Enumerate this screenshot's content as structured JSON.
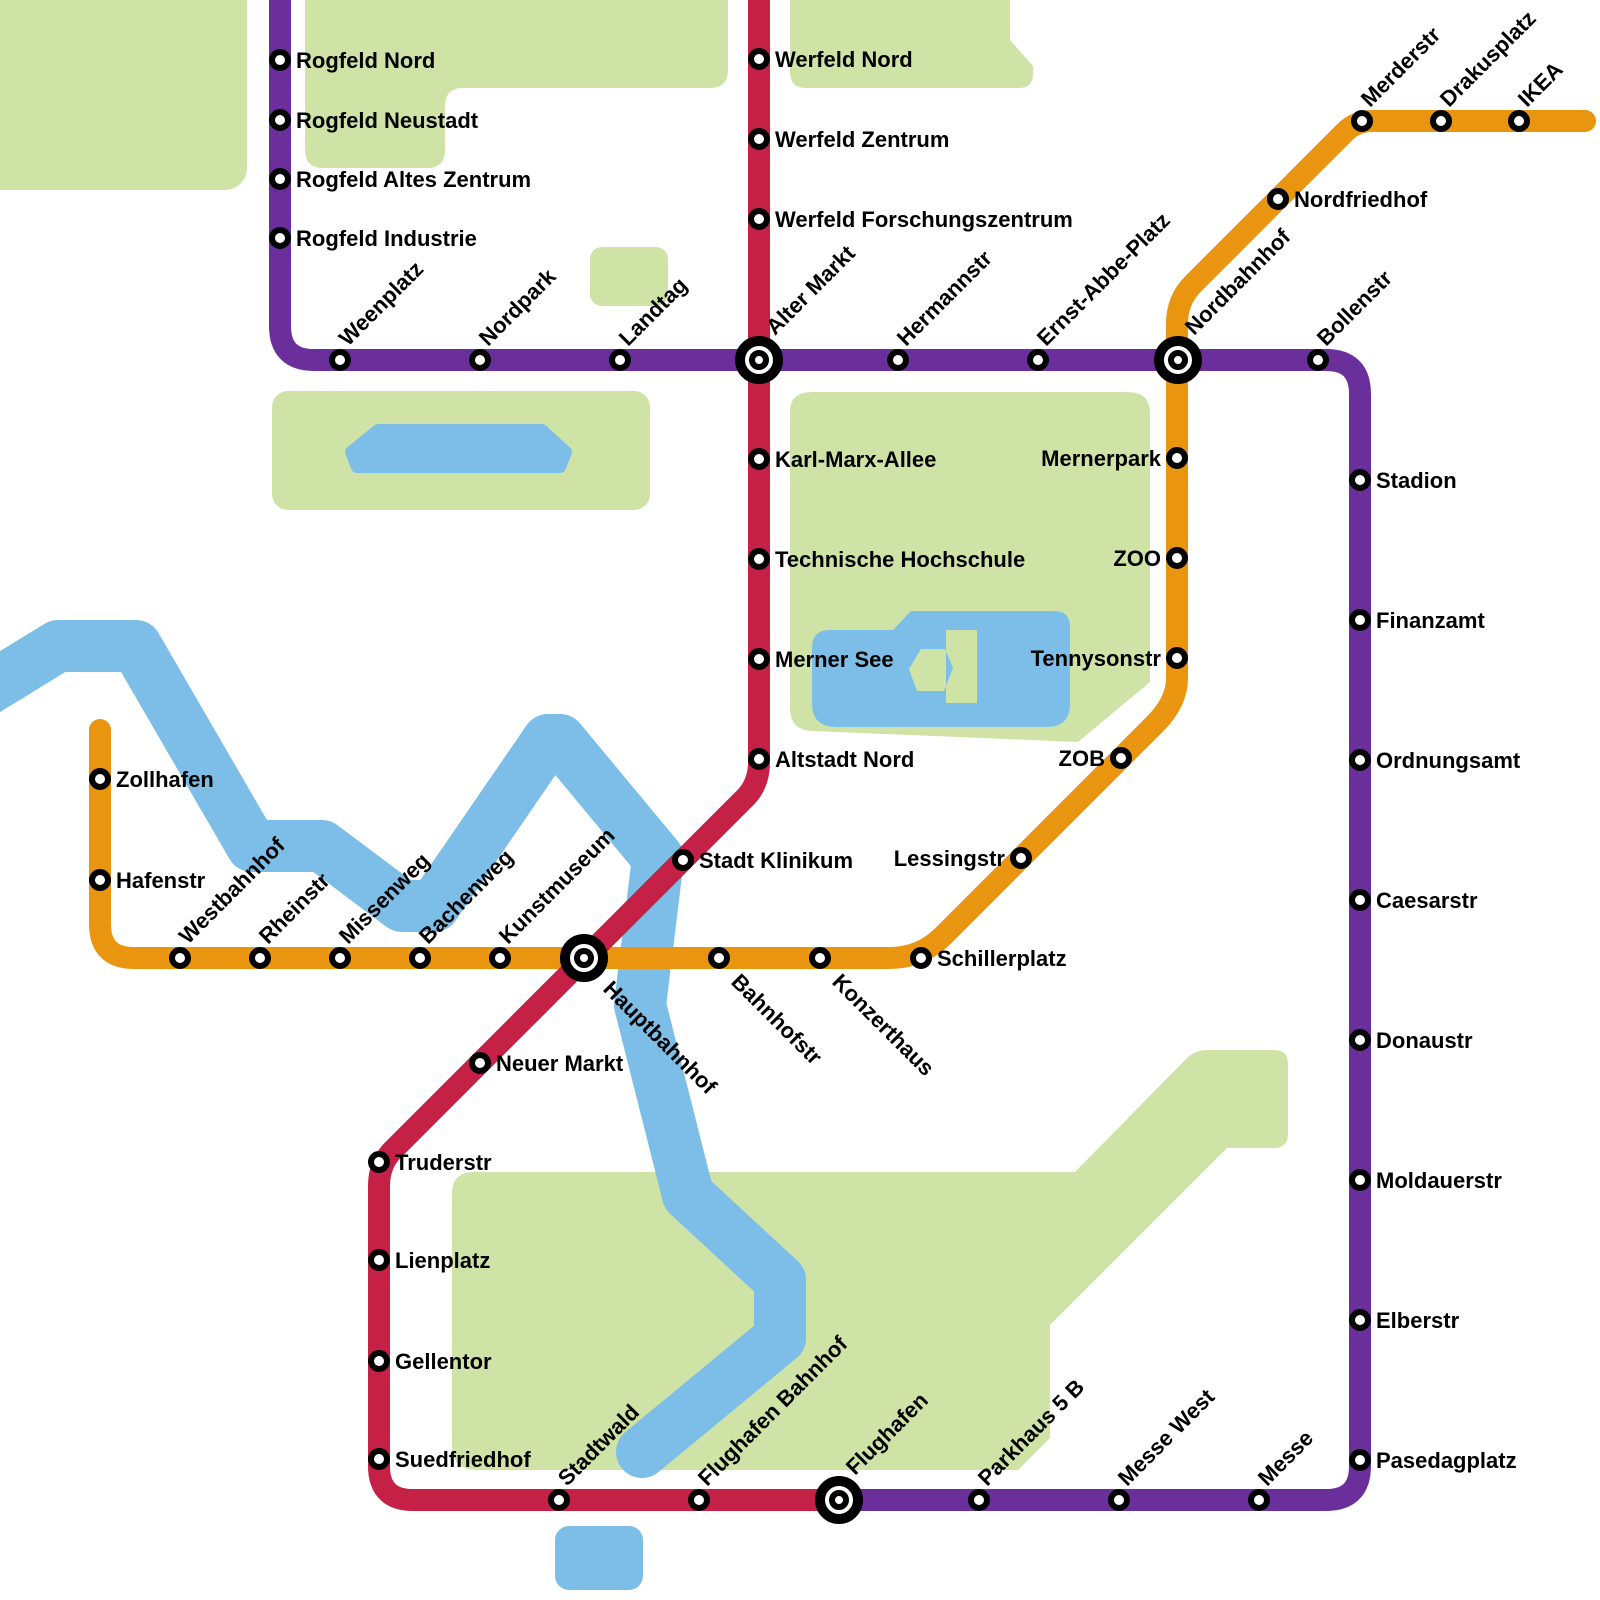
{
  "canvas": {
    "width": 1600,
    "height": 1600,
    "background": "#ffffff"
  },
  "colors": {
    "purple_line": "#6B2F9C",
    "red_line": "#C52045",
    "orange_line": "#E9950F",
    "park_green": "#CFE3A6",
    "water_blue": "#7DBEE8",
    "station_fill": "#FFFFFF",
    "station_ring": "#000000",
    "label_color": "#000000"
  },
  "style": {
    "line_width": 22,
    "river_width": 52,
    "font_size": 22,
    "station_radius": 8,
    "station_stroke": 6,
    "interchange_outer_radius": 19,
    "interchange_outer_stroke": 10,
    "interchange_inner_radius": 7,
    "interchange_inner_stroke": 6
  },
  "parks": [
    {
      "name": "park-northwest",
      "type": "rect",
      "x": -30,
      "y": -30,
      "w": 277,
      "h": 220,
      "r": 22
    },
    {
      "name": "park-north-middle",
      "type": "path",
      "d": "M 305 -20 L 728 -20 L 728 70 Q 728 88 710 88 L 463 88 Q 445 88 445 106 L 445 150 Q 445 168 427 168 L 323 168 Q 305 168 305 150 Z"
    },
    {
      "name": "park-north-right",
      "type": "path",
      "d": "M 790 -20 L 1010 -20 L 1010 40 L 1033 66 L 1033 74 Q 1033 88 1019 88 L 806 88 Q 790 88 790 72 Z"
    },
    {
      "name": "park-small-square",
      "type": "rect",
      "x": 590,
      "y": 247,
      "w": 78,
      "h": 59,
      "r": 12
    },
    {
      "name": "park-west",
      "type": "rect",
      "x": 272,
      "y": 391,
      "w": 378,
      "h": 119,
      "r": 16
    },
    {
      "name": "park-central-merner",
      "type": "path",
      "d": "M 812 392 Q 790 392 790 412 L 790 708 Q 790 730 812 731 L 1078 742 L 1150 682 L 1150 414 Q 1150 392 1128 392 Z"
    },
    {
      "name": "park-south-stadtwald",
      "type": "path",
      "d": "M 452 1194 Q 452 1172 474 1172 L 1075 1172 L 1186 1059 Q 1195 1050 1207 1050 L 1274 1050 Q 1288 1050 1288 1064 L 1288 1134 Q 1288 1148 1274 1148 L 1227 1148 L 1050 1325 L 1050 1438 L 1018 1470 L 478 1470 Q 452 1470 452 1446 Z"
    }
  ],
  "waters": [
    {
      "name": "river",
      "type": "polyline",
      "points": [
        [
          -30,
          700
        ],
        [
          58,
          646
        ],
        [
          136,
          646
        ],
        [
          252,
          846
        ],
        [
          322,
          846
        ],
        [
          402,
          906
        ],
        [
          434,
          906
        ],
        [
          548,
          740
        ],
        [
          560,
          740
        ],
        [
          658,
          858
        ],
        [
          640,
          1005
        ],
        [
          688,
          1195
        ],
        [
          780,
          1280
        ],
        [
          780,
          1338
        ],
        [
          642,
          1452
        ]
      ]
    },
    {
      "name": "west-lake",
      "type": "polygon",
      "points": [
        [
          378,
          430
        ],
        [
          542,
          430
        ],
        [
          566,
          452
        ],
        [
          560,
          467
        ],
        [
          357,
          467
        ],
        [
          351,
          452
        ]
      ]
    },
    {
      "name": "merner-see-lake",
      "type": "path",
      "d": "M 830 630 L 893 630 L 911 611 L 1054 611 Q 1070 611 1070 627 L 1070 704 Q 1070 727 1046 727 L 836 727 Q 812 727 812 703 L 812 648 Q 812 630 830 630 Z M 946 630 L 977 630 L 977 703 L 946 703 Z M 921 649 L 945 649 L 953 668 L 944 691 L 917 691 L 909 669 Z"
    },
    {
      "name": "south-pond",
      "type": "rect",
      "x": 555,
      "y": 1526,
      "w": 88,
      "h": 64,
      "r": 14
    }
  ],
  "lines": [
    {
      "id": "orange-line",
      "color_key": "orange_line",
      "d": "M 100 730 L 100 924 Q 100 958 134 958 L 889 958 Q 921 958 943 936 L 1155 724 Q 1177 702 1177 678 L 1177 324 Q 1177 300 1193 284 L 1345 132 Q 1356 121 1372 121 L 1585 121"
    },
    {
      "id": "purple-line",
      "color_key": "purple_line",
      "d": "M 280 -20 L 280 326 Q 280 360 314 360 L 1326 360 Q 1360 360 1360 394 L 1360 1466 Q 1360 1500 1326 1500 L 839 1500"
    },
    {
      "id": "red-line",
      "color_key": "red_line",
      "d": "M 759 -20 L 759 762 Q 759 784 745 798 L 393 1150 Q 379 1164 379 1186 L 379 1466 Q 379 1500 413 1500 L 839 1500"
    }
  ],
  "stations": [
    {
      "name": "Rogfeld Nord",
      "x": 280,
      "y": 60,
      "line": "purple",
      "type": "normal",
      "label": "right"
    },
    {
      "name": "Rogfeld Neustadt",
      "x": 280,
      "y": 120,
      "line": "purple",
      "type": "normal",
      "label": "right"
    },
    {
      "name": "Rogfeld Altes Zentrum",
      "x": 280,
      "y": 179,
      "line": "purple",
      "type": "normal",
      "label": "right"
    },
    {
      "name": "Rogfeld Industrie",
      "x": 280,
      "y": 238,
      "line": "purple",
      "type": "normal",
      "label": "right"
    },
    {
      "name": "Weenplatz",
      "x": 340,
      "y": 360,
      "line": "purple",
      "type": "normal",
      "label": "diag-up"
    },
    {
      "name": "Nordpark",
      "x": 480,
      "y": 360,
      "line": "purple",
      "type": "normal",
      "label": "diag-up"
    },
    {
      "name": "Landtag",
      "x": 620,
      "y": 360,
      "line": "purple",
      "type": "normal",
      "label": "diag-up"
    },
    {
      "name": "Alter Markt",
      "x": 759,
      "y": 360,
      "line": "purple,red",
      "type": "interchange",
      "label": "diag-up"
    },
    {
      "name": "Hermannstr",
      "x": 898,
      "y": 360,
      "line": "purple",
      "type": "normal",
      "label": "diag-up"
    },
    {
      "name": "Ernst-Abbe-Platz",
      "x": 1038,
      "y": 360,
      "line": "purple",
      "type": "normal",
      "label": "diag-up"
    },
    {
      "name": "Nordbahnhof",
      "x": 1178,
      "y": 360,
      "line": "purple,orange",
      "type": "interchange",
      "label": "diag-up"
    },
    {
      "name": "Bollenstr",
      "x": 1318,
      "y": 360,
      "line": "purple",
      "type": "normal",
      "label": "diag-up"
    },
    {
      "name": "Stadion",
      "x": 1360,
      "y": 480,
      "line": "purple",
      "type": "normal",
      "label": "right"
    },
    {
      "name": "Finanzamt",
      "x": 1360,
      "y": 620,
      "line": "purple",
      "type": "normal",
      "label": "right"
    },
    {
      "name": "Ordnungsamt",
      "x": 1360,
      "y": 760,
      "line": "purple",
      "type": "normal",
      "label": "right"
    },
    {
      "name": "Caesarstr",
      "x": 1360,
      "y": 900,
      "line": "purple",
      "type": "normal",
      "label": "right"
    },
    {
      "name": "Donaustr",
      "x": 1360,
      "y": 1040,
      "line": "purple",
      "type": "normal",
      "label": "right"
    },
    {
      "name": "Moldauerstr",
      "x": 1360,
      "y": 1180,
      "line": "purple",
      "type": "normal",
      "label": "right"
    },
    {
      "name": "Elberstr",
      "x": 1360,
      "y": 1320,
      "line": "purple",
      "type": "normal",
      "label": "right"
    },
    {
      "name": "Pasedagplatz",
      "x": 1360,
      "y": 1460,
      "line": "purple",
      "type": "normal",
      "label": "right"
    },
    {
      "name": "Messe",
      "x": 1259,
      "y": 1500,
      "line": "purple",
      "type": "normal",
      "label": "diag-up"
    },
    {
      "name": "Messe West",
      "x": 1119,
      "y": 1500,
      "line": "purple",
      "type": "normal",
      "label": "diag-up"
    },
    {
      "name": "Parkhaus 5 B",
      "x": 979,
      "y": 1500,
      "line": "purple",
      "type": "normal",
      "label": "diag-up"
    },
    {
      "name": "Flughafen",
      "x": 839,
      "y": 1500,
      "line": "purple,red",
      "type": "interchange",
      "label": "diag-up"
    },
    {
      "name": "Werfeld Nord",
      "x": 759,
      "y": 59,
      "line": "red",
      "type": "normal",
      "label": "right"
    },
    {
      "name": "Werfeld Zentrum",
      "x": 759,
      "y": 139,
      "line": "red",
      "type": "normal",
      "label": "right"
    },
    {
      "name": "Werfeld Forschungszentrum",
      "x": 759,
      "y": 219,
      "line": "red",
      "type": "normal",
      "label": "right"
    },
    {
      "name": "Karl-Marx-Allee",
      "x": 759,
      "y": 459,
      "line": "red",
      "type": "normal",
      "label": "right"
    },
    {
      "name": "Technische Hochschule",
      "x": 759,
      "y": 559,
      "line": "red",
      "type": "normal",
      "label": "right"
    },
    {
      "name": "Merner See",
      "x": 759,
      "y": 659,
      "line": "red",
      "type": "normal",
      "label": "right"
    },
    {
      "name": "Altstadt Nord",
      "x": 759,
      "y": 759,
      "line": "red",
      "type": "normal",
      "label": "right"
    },
    {
      "name": "Stadt Klinikum",
      "x": 683,
      "y": 860,
      "line": "red",
      "type": "normal",
      "label": "right"
    },
    {
      "name": "Hauptbahnhof",
      "x": 584,
      "y": 958,
      "line": "red,orange",
      "type": "interchange",
      "label": "diag-down"
    },
    {
      "name": "Neuer Markt",
      "x": 480,
      "y": 1063,
      "line": "red",
      "type": "normal",
      "label": "right"
    },
    {
      "name": "Truderstr",
      "x": 379,
      "y": 1162,
      "line": "red",
      "type": "normal",
      "label": "right"
    },
    {
      "name": "Lienplatz",
      "x": 379,
      "y": 1260,
      "line": "red",
      "type": "normal",
      "label": "right"
    },
    {
      "name": "Gellentor",
      "x": 379,
      "y": 1361,
      "line": "red",
      "type": "normal",
      "label": "right"
    },
    {
      "name": "Suedfriedhof",
      "x": 379,
      "y": 1459,
      "line": "red",
      "type": "normal",
      "label": "right"
    },
    {
      "name": "Stadtwald",
      "x": 559,
      "y": 1500,
      "line": "red",
      "type": "normal",
      "label": "diag-up"
    },
    {
      "name": "Flughafen Bahnhof",
      "x": 699,
      "y": 1500,
      "line": "red",
      "type": "normal",
      "label": "diag-up"
    },
    {
      "name": "Zollhafen",
      "x": 100,
      "y": 779,
      "line": "orange",
      "type": "normal",
      "label": "right"
    },
    {
      "name": "Hafenstr",
      "x": 100,
      "y": 880,
      "line": "orange",
      "type": "normal",
      "label": "right"
    },
    {
      "name": "Westbahnhof",
      "x": 180,
      "y": 958,
      "line": "orange",
      "type": "normal",
      "label": "diag-up"
    },
    {
      "name": "Rheinstr",
      "x": 260,
      "y": 958,
      "line": "orange",
      "type": "normal",
      "label": "diag-up"
    },
    {
      "name": "Missenweg",
      "x": 340,
      "y": 958,
      "line": "orange",
      "type": "normal",
      "label": "diag-up"
    },
    {
      "name": "Bachenweg",
      "x": 420,
      "y": 958,
      "line": "orange",
      "type": "normal",
      "label": "diag-up"
    },
    {
      "name": "Kunstmuseum",
      "x": 500,
      "y": 958,
      "line": "orange",
      "type": "normal",
      "label": "diag-up"
    },
    {
      "name": "Bahnhofstr",
      "x": 719,
      "y": 958,
      "line": "orange",
      "type": "normal",
      "label": "diag-down"
    },
    {
      "name": "Konzerthaus",
      "x": 820,
      "y": 958,
      "line": "orange",
      "type": "normal",
      "label": "diag-down"
    },
    {
      "name": "Schillerplatz",
      "x": 921,
      "y": 958,
      "line": "orange",
      "type": "normal",
      "label": "right"
    },
    {
      "name": "Lessingstr",
      "x": 1021,
      "y": 858,
      "line": "orange",
      "type": "normal",
      "label": "left"
    },
    {
      "name": "ZOB",
      "x": 1121,
      "y": 758,
      "line": "orange",
      "type": "normal",
      "label": "left"
    },
    {
      "name": "Tennysonstr",
      "x": 1177,
      "y": 658,
      "line": "orange",
      "type": "normal",
      "label": "left"
    },
    {
      "name": "ZOO",
      "x": 1177,
      "y": 558,
      "line": "orange",
      "type": "normal",
      "label": "left"
    },
    {
      "name": "Mernerpark",
      "x": 1177,
      "y": 458,
      "line": "orange",
      "type": "normal",
      "label": "left"
    },
    {
      "name": "Nordfriedhof",
      "x": 1278,
      "y": 199,
      "line": "orange",
      "type": "normal",
      "label": "right"
    },
    {
      "name": "Merderstr",
      "x": 1362,
      "y": 121,
      "line": "orange",
      "type": "normal",
      "label": "diag-up"
    },
    {
      "name": "Drakusplatz",
      "x": 1441,
      "y": 121,
      "line": "orange",
      "type": "normal",
      "label": "diag-up"
    },
    {
      "name": "IKEA",
      "x": 1519,
      "y": 121,
      "line": "orange",
      "type": "normal",
      "label": "diag-up"
    }
  ]
}
